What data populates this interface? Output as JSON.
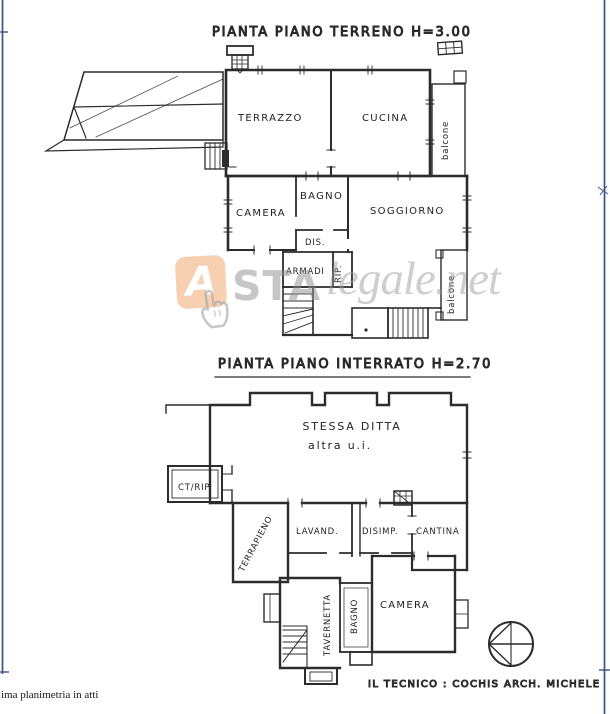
{
  "document": {
    "footer_note": "ima planimetria in atti",
    "technician": "IL TECNICO : COCHIS ARCH. MICHELE",
    "ink_color": "#2c2c2c",
    "border_color": "#3c5486"
  },
  "watermark": {
    "logo_letter": "A",
    "bold_text": "STA",
    "italic_text": "legale.net",
    "logo_color": "#e98b3e",
    "text_color": "#9a9a9a",
    "cursor_icon": "hand-pointer"
  },
  "ground_floor": {
    "title": "PIANTA PIANO TERRENO H=3.00",
    "labels": {
      "terrazzo": "TERRAZZO",
      "cucina": "CUCINA",
      "balcone_upper": "balcone",
      "camera": "CAMERA",
      "bagno": "BAGNO",
      "dis": "DIS.",
      "soggiorno": "SOGGIORNO",
      "armadi": "ARMADI",
      "rip": "RIP.",
      "balcone_lower": "balcone"
    }
  },
  "basement": {
    "title": "PIANTA PIANO INTERRATO H=2.70",
    "labels": {
      "stessa_ditta": "STESSA DITTA",
      "altra_ui": "altra u.i.",
      "ct_rip": "CT/RIP.",
      "terrapieno": "TERRAPIENO",
      "lavanderia": "LAVAND.",
      "disimpegno": "DISIMP.",
      "cantina": "CANTINA",
      "tavernetta": "TAVERNETTA",
      "bagno": "BAGNO",
      "camera": "CAMERA"
    }
  }
}
